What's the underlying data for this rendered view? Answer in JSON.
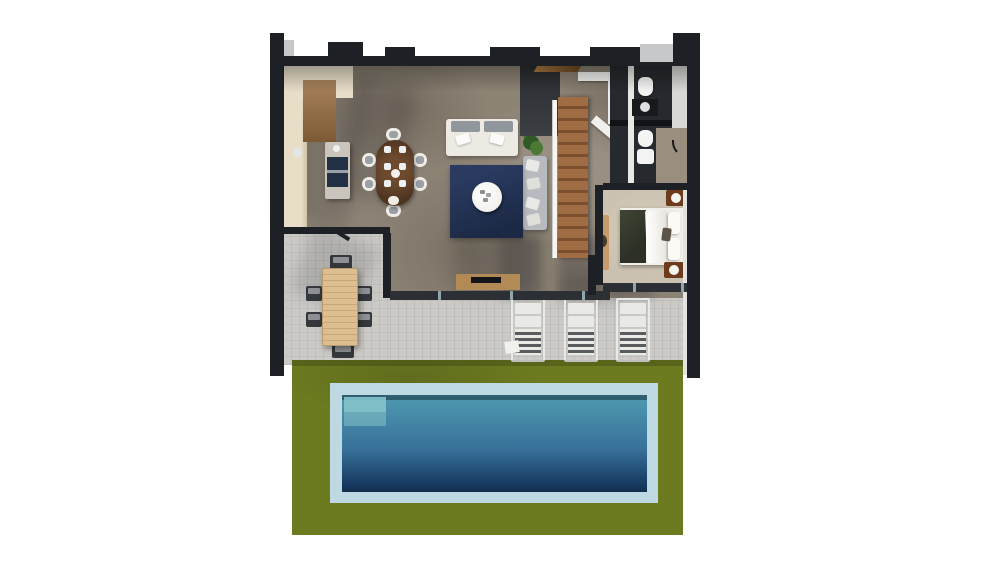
{
  "scene": {
    "type": "3d-floor-plan-render",
    "description": "Top-down 3D render of a single-storey villa with garden and pool",
    "rooms": [
      {
        "name": "kitchen"
      },
      {
        "name": "dining-area"
      },
      {
        "name": "living-room"
      },
      {
        "name": "entry-hall"
      },
      {
        "name": "staircase"
      },
      {
        "name": "bathroom"
      },
      {
        "name": "bedroom"
      },
      {
        "name": "terrace"
      },
      {
        "name": "garden"
      },
      {
        "name": "swimming-pool"
      }
    ],
    "furniture": [
      "kitchen-counter",
      "kitchen-island",
      "dining-table-with-6-chairs",
      "double-sofa-white",
      "sectional-sofa-gray",
      "round-coffee-table",
      "navy-rug",
      "potted-plant",
      "tv-console",
      "wooden-staircase",
      "double-bed",
      "two-nightstands-with-lamps",
      "bedroom-bench",
      "toilet",
      "washbasin",
      "outdoor-dining-table-with-6-chairs",
      "sun-lounger-1",
      "sun-lounger-2",
      "sun-lounger-3",
      "pool-steps"
    ]
  },
  "palette": {
    "white-bg": "#ffffff",
    "wall": "#1d2024",
    "wall-soft": "#2c3034",
    "wall-gray": "#c6c8c9",
    "concrete": "#8d8375",
    "concrete-dark": "#6b6257",
    "patio": "#cbcac6",
    "grass": "#6d7b20",
    "coping": "#bed9e2",
    "water-top": "#4f9aaf",
    "water-mid": "#38719a",
    "water-deep": "#173b62",
    "step": "#86c3cb",
    "cream": "#e8dec8",
    "cabinet": "#a8835c",
    "island-top": "#c9c5bc",
    "island-front": "#223144",
    "table-wood": "#4e3522",
    "chair-white": "#f0ede6",
    "chair-gray": "#9aa0a6",
    "sofa-white": "#eceae3",
    "cushion-gray": "#8f969c",
    "sofa-gray": "#b7bbbf",
    "rug": "#2a3a60",
    "rug-dark": "#1c2945",
    "coffee-white": "#f2f1ed",
    "stair-wood": "#a06c44",
    "stair-gap": "#7c4f2e",
    "railing": "#f5f5f3",
    "plant": "#4c7a36",
    "plant-dark": "#2f5a26",
    "bath-floor": "#26292d",
    "fixture": "#f4f4f2",
    "bed-rug": "#cbc1b0",
    "bed-white": "#f1efe8",
    "throw": "#3f4534",
    "night-wood": "#6e3c1c",
    "bench-wood": "#c59b6b",
    "out-table": "#dcbe90",
    "out-chair": "#34373b",
    "lounger": "#e9e9e6",
    "lounger-slat": "#595c5f",
    "tv-wood": "#b28a55",
    "shadow": "rgba(25,25,30,0.22)"
  }
}
